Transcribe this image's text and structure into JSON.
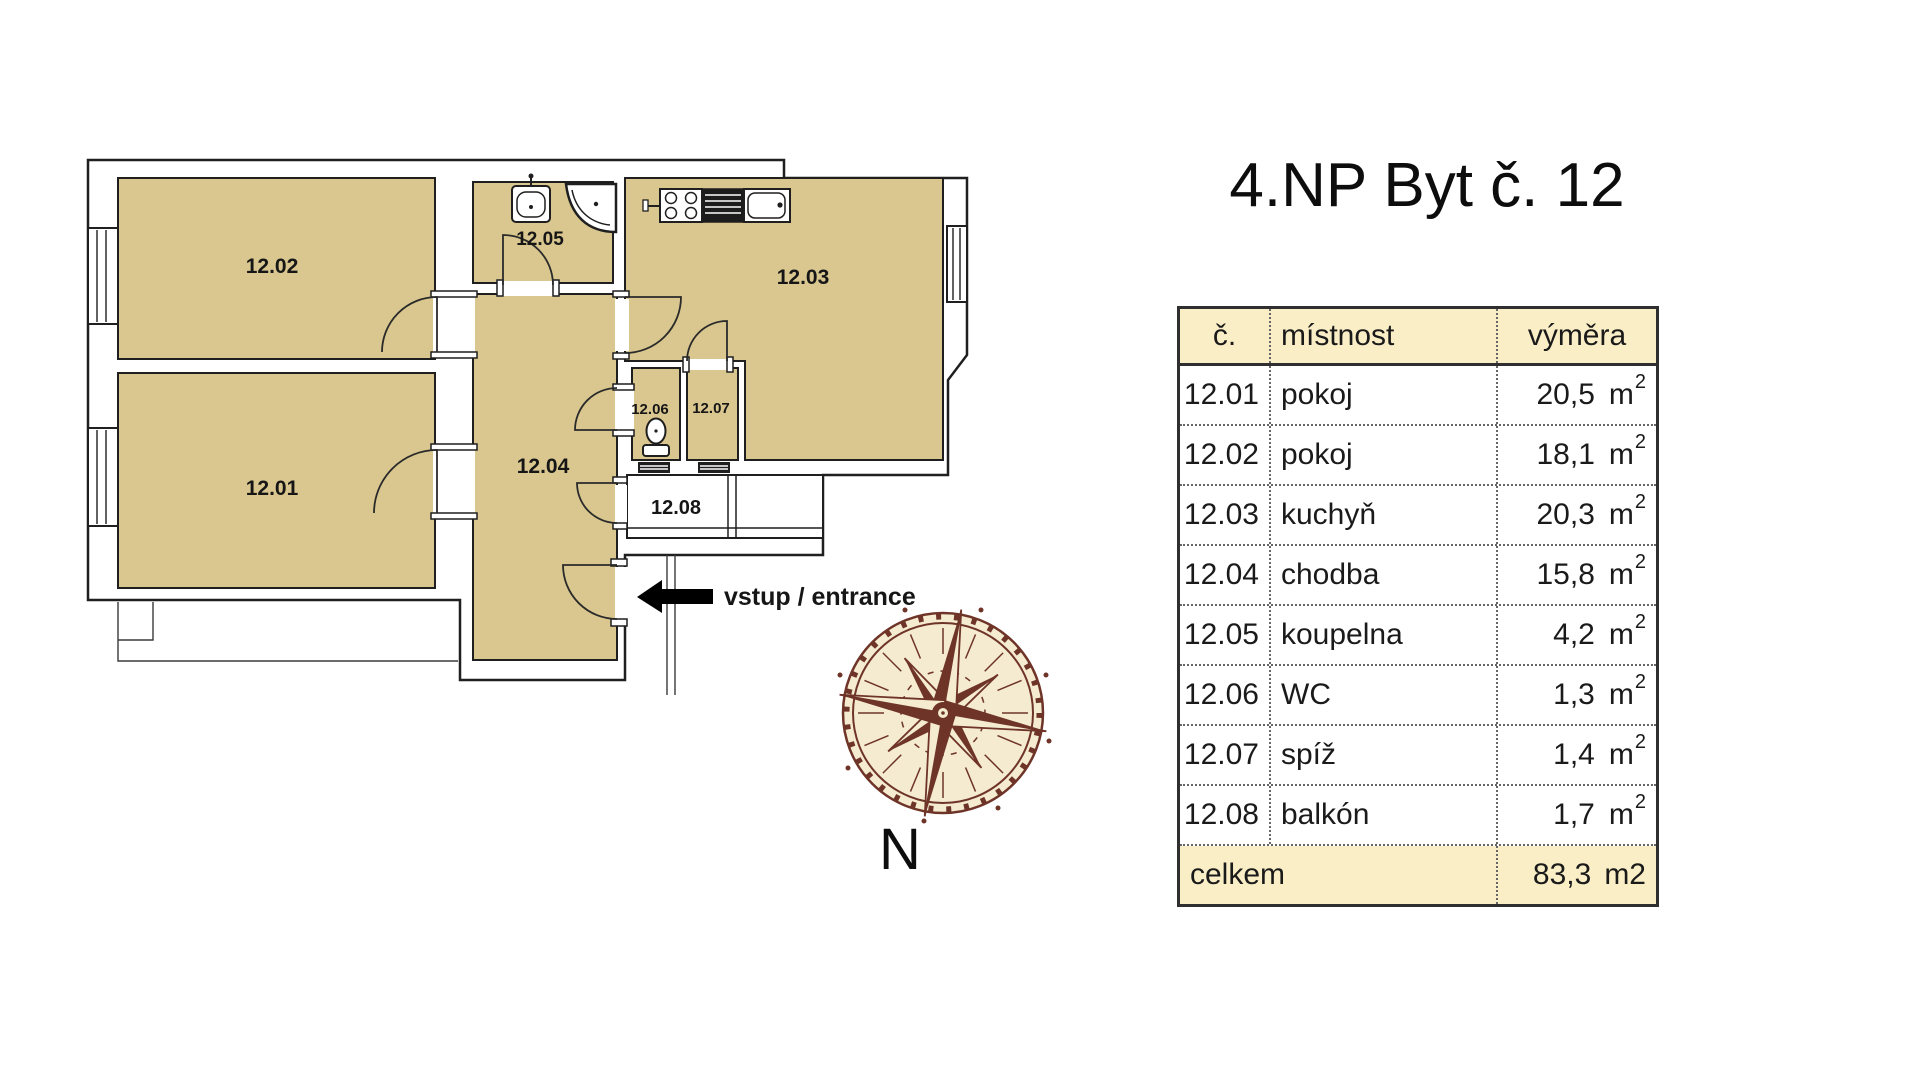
{
  "title": "4.NP Byt č. 12",
  "colors": {
    "room_fill": "#d9c78f",
    "wall_stroke": "#1f1f1f",
    "table_header_bg": "#faeec6",
    "compass_brown": "#6f3428",
    "compass_cream": "#f4ebd1",
    "arrow_black": "#000000"
  },
  "plan": {
    "rooms": {
      "r1201": "12.01",
      "r1202": "12.02",
      "r1203": "12.03",
      "r1204": "12.04",
      "r1205": "12.05",
      "r1206": "12.06",
      "r1207": "12.07",
      "r1208": "12.08"
    },
    "entrance_label": "vstup / entrance",
    "north_label": "N"
  },
  "table": {
    "headers": {
      "no": "č.",
      "room": "místnost",
      "area": "výměra"
    },
    "unit": {
      "base": "m",
      "exp": "2"
    },
    "rows": [
      {
        "no": "12.01",
        "room": "pokoj",
        "area": "20,5"
      },
      {
        "no": "12.02",
        "room": "pokoj",
        "area": "18,1"
      },
      {
        "no": "12.03",
        "room": "kuchyň",
        "area": "20,3"
      },
      {
        "no": "12.04",
        "room": "chodba",
        "area": "15,8"
      },
      {
        "no": "12.05",
        "room": "koupelna",
        "area": "4,2"
      },
      {
        "no": "12.06",
        "room": "WC",
        "area": "1,3"
      },
      {
        "no": "12.07",
        "room": "spíž",
        "area": "1,4"
      },
      {
        "no": "12.08",
        "room": "balkón",
        "area": "1,7"
      }
    ],
    "footer": {
      "label": "celkem",
      "value": "83,3",
      "unit": "m2"
    }
  }
}
